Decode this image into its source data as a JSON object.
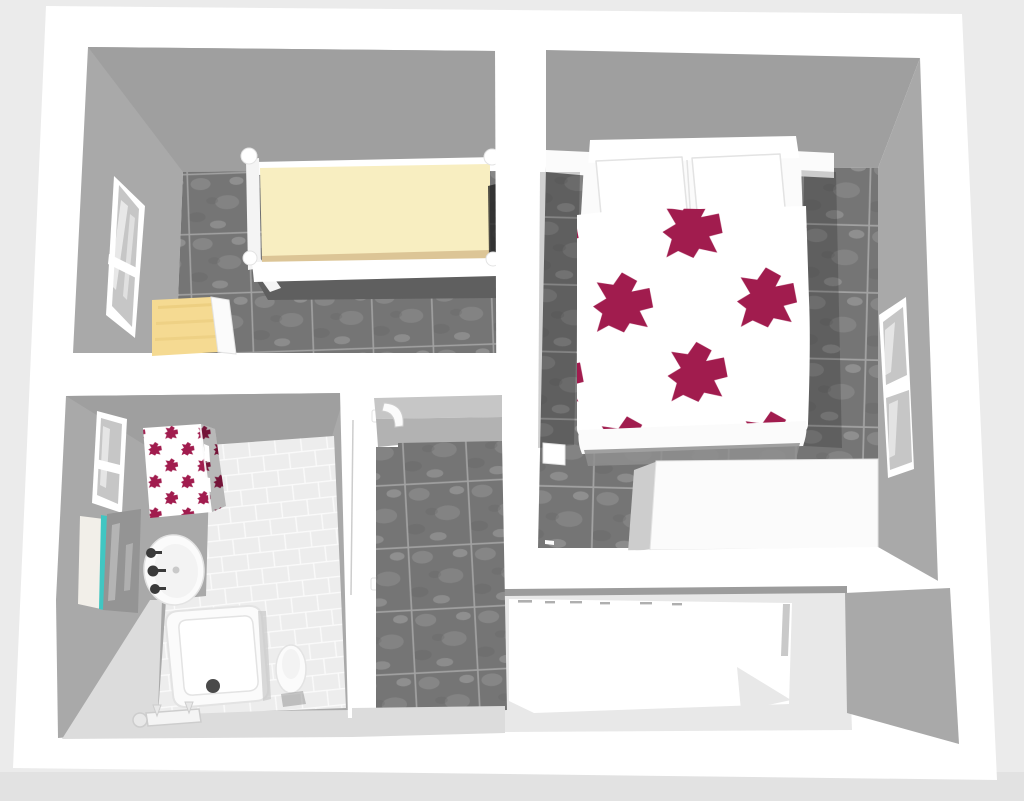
{
  "app": {
    "label": "3D aerial render of an apartment floor plan"
  },
  "palette": {
    "bg": "#ebebeb",
    "bg_lower": "#e2e2e2",
    "wall_white": "#ffffff",
    "soft_white": "#fbfbfb",
    "face_gray": "#a9a9a9",
    "face_gray_dark": "#9f9f9f",
    "face_light": "#c6c6c6",
    "face_mid": "#b2b2b2",
    "floor_light": "#dcdcdc",
    "floor_south": "#e8e8e8",
    "tile_base": "#757575",
    "tile_grout": "#a2a2a2",
    "speckle_light": "#989898",
    "speckle_faint": "#c0c0c0",
    "speckle_dark": "#616161",
    "btile_base": "#ededed",
    "btile_grout": "#fafafa",
    "maroon": "#a11c4e",
    "maroon_deep": "#8c1743",
    "cream": "#f8eec1",
    "cream_edge": "#dcc596",
    "wood": "#f5da92",
    "wood_grain": "#e8c877",
    "cyan": "#41c6c2",
    "knob_dark": "#3a3a3a",
    "drain_dark": "#4a4a4a",
    "pane": "#c6c6c6",
    "mirror": "#949494",
    "panel_cream": "#f2efe9",
    "shadow_dark": "#5f5f5f",
    "shadow_soft": "#8f8f8f",
    "line_gray": "#9c9c9c",
    "bevel": "#cdcdcd",
    "sliver": "#c9c9c9",
    "edge_light": "#e3e3e3",
    "inner_white": "#f3f3f3",
    "fold_gray": "#e8e8e8",
    "gap_dark": "#232323",
    "frame_white": "#f4f4f4"
  },
  "scene": {
    "rooms": [
      {
        "id": "bedroom-single",
        "furniture": [
          "single-bed",
          "bedside-cabinet",
          "wall-window"
        ]
      },
      {
        "id": "bedroom-double",
        "furniture": [
          "double-bed",
          "patterned-duvet",
          "pillows",
          "wardrobe",
          "nightstand",
          "wall-window"
        ]
      },
      {
        "id": "bathroom",
        "furniture": [
          "patterned-cabinet",
          "washbasin",
          "shower-tray",
          "toilet",
          "mirror-panel",
          "wall-window",
          "shower-valve"
        ]
      },
      {
        "id": "hallway",
        "furniture": [
          "door-frame",
          "door-handle"
        ]
      },
      {
        "id": "south-room",
        "furniture": [
          "white-furniture-block"
        ]
      }
    ]
  }
}
